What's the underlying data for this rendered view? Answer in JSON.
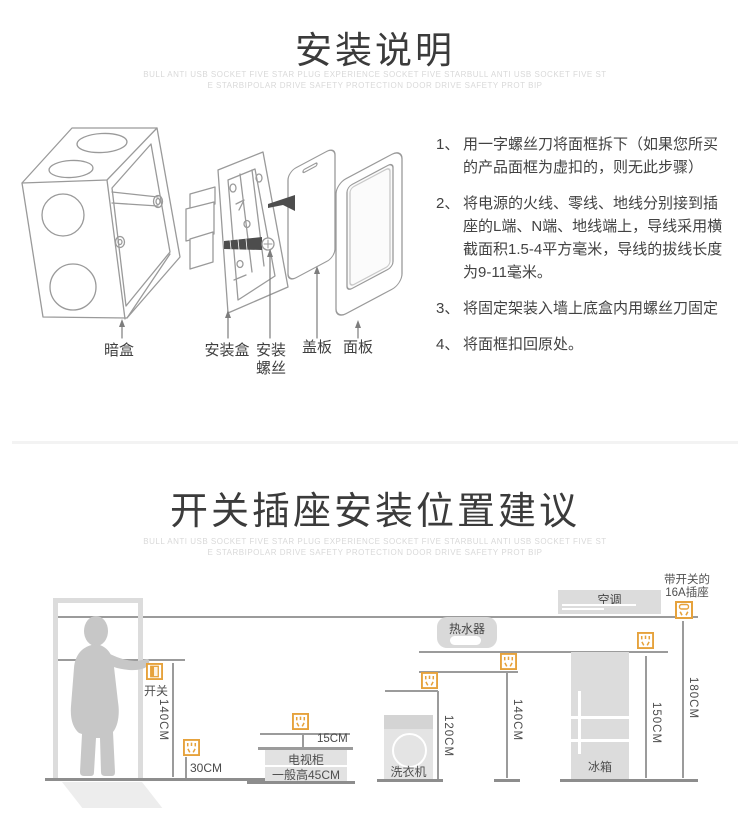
{
  "accent_color": "#E6A23C",
  "line_color": "#9b9b9b",
  "section1": {
    "title": "安装说明",
    "subtitle1": "BULL ANTI USB SOCKET FIVE STAR PLUG EXPERIENCE SOCKET FIVE STARBULL ANTI USB SOCKET FIVE ST",
    "subtitle2": "E STARBIPOLAR DRIVE SAFETY PROTECTION DOOR  DRIVE SAFETY PROT BIP",
    "parts": {
      "box": "暗盒",
      "frame": "安装盒",
      "screw_line1": "安装",
      "screw_line2": "螺丝",
      "cover": "盖板",
      "panel": "面板"
    },
    "steps": [
      {
        "num": "1、",
        "text": "用一字螺丝刀将面框拆下（如果您所买的产品面框为虚扣的，则无此步骤）"
      },
      {
        "num": "2、",
        "text": "将电源的火线、零线、地线分别接到插座的L端、N端、地线端上，导线采用横截面积1.5-4平方毫米，导线的拔线长度为9-11毫米。"
      },
      {
        "num": "3、",
        "text": "将固定架装入墙上底盒内用螺丝刀固定"
      },
      {
        "num": "4、",
        "text": "将面框扣回原处。"
      }
    ]
  },
  "section2": {
    "title": "开关插座安装位置建议",
    "subtitle1": "BULL ANTI USB SOCKET FIVE STAR PLUG EXPERIENCE SOCKET FIVE STARBULL ANTI USB SOCKET FIVE ST",
    "subtitle2": "E STARBIPOLAR DRIVE SAFETY PROTECTION DOOR  DRIVE SAFETY PROT BIP",
    "door": {
      "switch_label": "开关",
      "switch_height": "140CM",
      "socket_height": "30CM"
    },
    "tv": {
      "gap": "15CM",
      "name": "电视柜",
      "height_note": "一般高45CM"
    },
    "washer": {
      "name": "洗衣机",
      "socket_height": "120CM"
    },
    "heater": {
      "name": "热水器",
      "socket_height": "140CM"
    },
    "ac": {
      "name": "空调",
      "socket_label1": "带开关的",
      "socket_label2": "16A插座",
      "socket_height": "180CM"
    },
    "fridge": {
      "name": "冰箱",
      "socket_height": "150CM"
    }
  },
  "icons": {
    "socket": "five-hole-socket",
    "switch": "wall-switch",
    "switched_socket": "switched-16a-socket"
  }
}
